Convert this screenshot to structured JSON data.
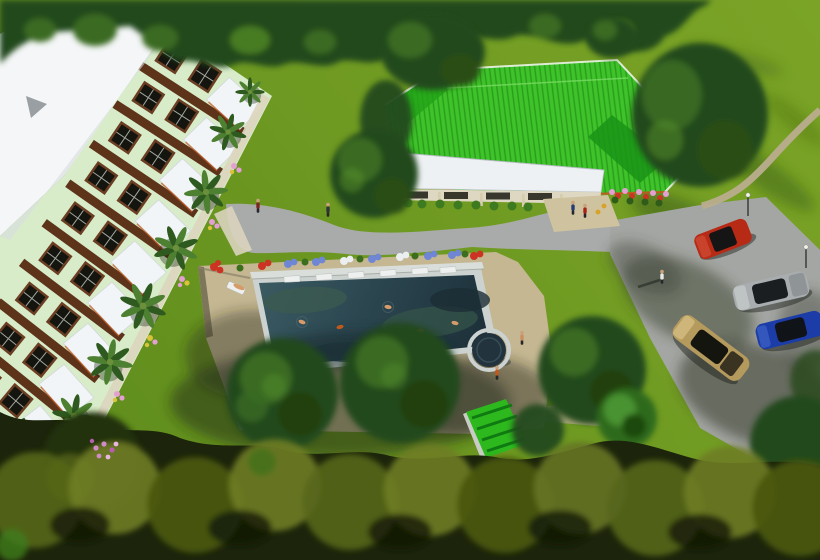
{
  "scene": {
    "description": "Aerial 3D architectural rendering of a resort: a long residential building with white roof and awnings on the left, a bright green hip-roof clubhouse at top center, a rectangular swimming pool with circular spa, planters of flowers, palm trees, curved gray walkways, and a parking lot with four cars (red, silver, blue, tan) surrounded by lawns and dense trees",
    "type": "architectural-aerial-render",
    "objects": {
      "residential_building": 1,
      "clubhouse": 1,
      "swimming_pool": 1,
      "spa_circle": 1,
      "pool_shed": 1,
      "cars": [
        "red",
        "silver",
        "blue",
        "tan"
      ],
      "street_lamps": 2,
      "palm_trees": 9,
      "people_visible": 10,
      "swimmers": 5,
      "sun_loungers": 7,
      "flower_planters": 10
    }
  },
  "colors": {
    "grass1": "#7ba426",
    "grass2": "#6f9a22",
    "grass3": "#5e8c1c",
    "treeDark": "#24481a",
    "treeMid": "#3a6a22",
    "treeLight": "#57922a",
    "treeOliveDark": "#1c240b",
    "olive1": "#55661a",
    "olive2": "#6f7d24",
    "olive3": "#49560f",
    "pathGray": "#a9abaa",
    "parkingGray": "#a4a6a3",
    "trailTan": "#b9ad8e",
    "deckTan": "#c4b791",
    "buildingWall": "#d8ecca",
    "roofWhite": "#f4f6f7",
    "awningWhite": "#f2f5f7",
    "slabBrown": "#5d3319",
    "bayBrown": "#6b3d22",
    "windowDark": "#15150f",
    "roofGreen": "#3fc32a",
    "roofGreenDark": "#1a9416",
    "eaveOrange": "#c4571d",
    "canopyWhite": "#eef1f4",
    "poolCoping": "#ccd2d0",
    "waterLight": "#3a5a62",
    "waterMid": "#2a444e",
    "waterDark": "#1c2f38",
    "spaWater": "#22333d",
    "shedGreen": "#2db81e",
    "shedGreenDark": "#0f7a12",
    "carRed": "#b62a16",
    "carSilver": "#a9adb0",
    "carBlue": "#1c3da8",
    "carTan": "#b49a5c",
    "flowerPink": "#e3a0d2",
    "flowerRed": "#cc3322",
    "flowerBlue": "#6f86d6",
    "flowerWhite": "#eceff2",
    "flowerYellow": "#d9c33a",
    "palmDark": "#2e5a20",
    "palmLight": "#4d8030",
    "skin": "#d79b6a"
  }
}
